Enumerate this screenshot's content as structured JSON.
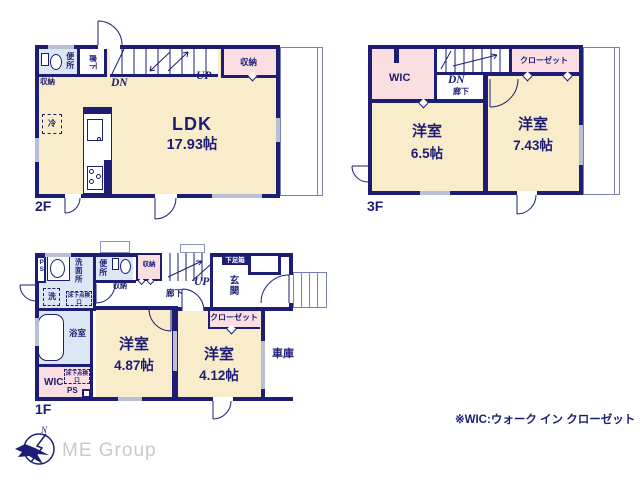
{
  "colors": {
    "wall_navy": "#1d1d75",
    "room_beige": "#f8ecca",
    "closet_pink": "#fadee2",
    "water_blue": "#dbe7f4",
    "window_gray": "#b9c0d6",
    "brand_gray": "#c9c9c9"
  },
  "floors": {
    "f2": {
      "label": "2F",
      "ldk": "LDK",
      "ldk_size": "17.93帖",
      "toilet": "便所",
      "hall": "廊下",
      "storage_top": "収納",
      "storage_left": "収納",
      "fridge": "冷",
      "dn": "DN",
      "up": "UP"
    },
    "f3": {
      "label": "3F",
      "wic": "WIC",
      "dn": "DN",
      "hall": "廊下",
      "closet": "クローゼット",
      "room1": "洋室",
      "room1_size": "6.5帖",
      "room2": "洋室",
      "room2_size": "7.43帖"
    },
    "f1": {
      "label": "1F",
      "ps_top": "PS",
      "washroom": "洗面所",
      "laundry": "洗",
      "hatch_top": "床下点検口",
      "toilet": "便所",
      "storage": "収納",
      "storage_small": "収納",
      "hall": "廊下",
      "up": "UP",
      "shoebox": "下足箱",
      "entrance": "玄関",
      "closet": "クローゼット",
      "bath": "浴室",
      "wic": "WIC",
      "hatch_bottom": "床下点検口",
      "ps_bottom": "PS",
      "room1": "洋室",
      "room1_size": "4.87帖",
      "room2": "洋室",
      "room2_size": "4.12帖",
      "garage": "車庫"
    }
  },
  "footer": {
    "note": "※WIC:ウォーク イン クローゼット",
    "brand": "ME Group",
    "north": "N"
  }
}
